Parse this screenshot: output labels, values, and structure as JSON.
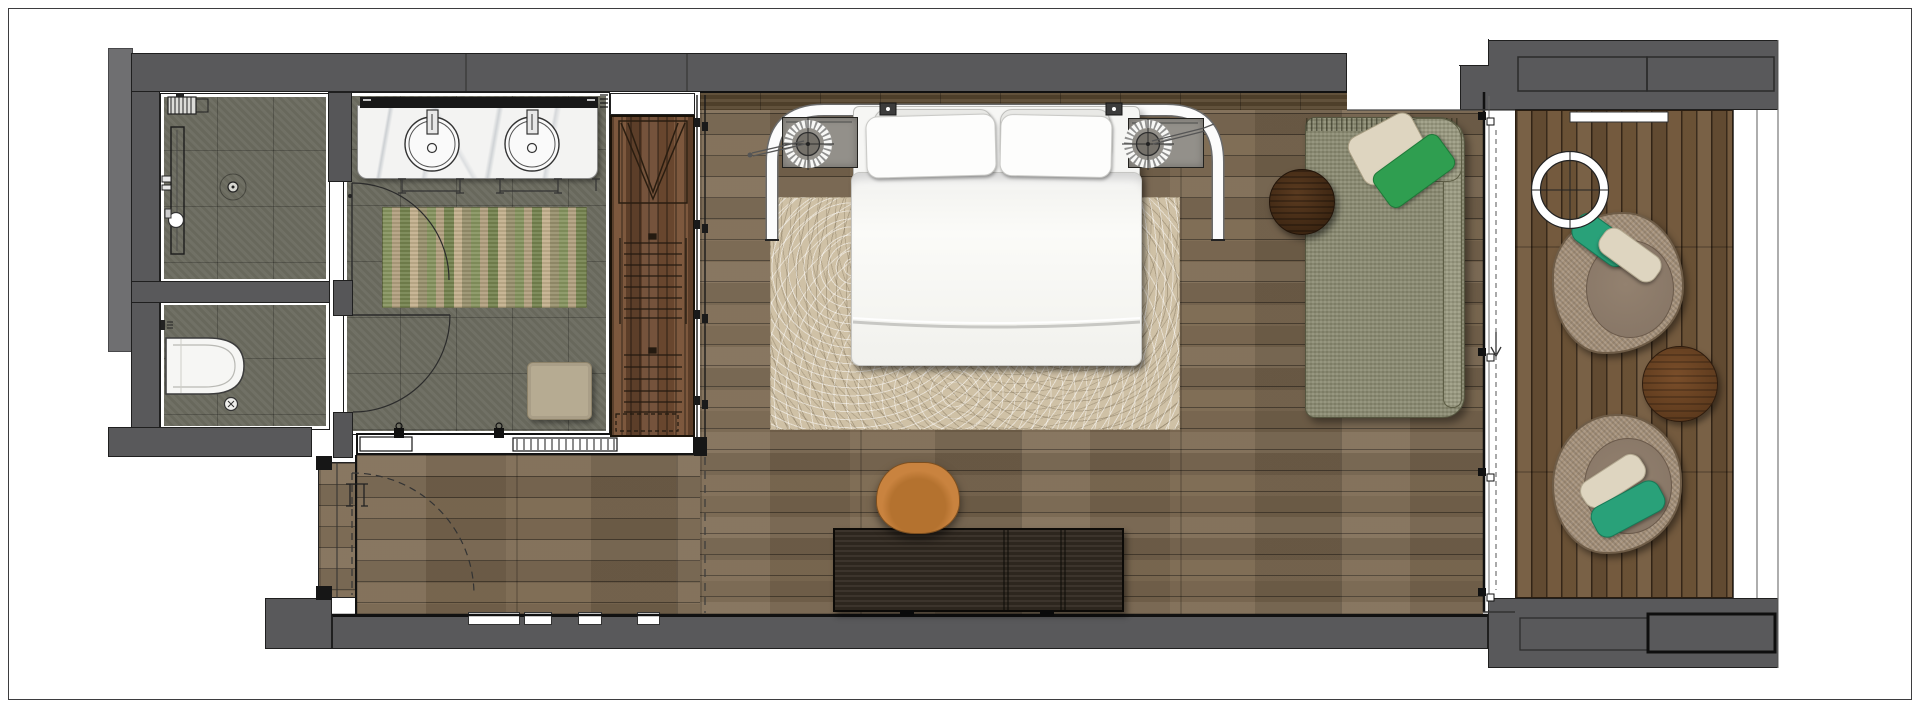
{
  "meta": {
    "width": 1920,
    "height": 708,
    "drawing_type": "hotel-guest-room-floor-plan",
    "text_labels": []
  },
  "palette": {
    "wall": "#59595b",
    "wall-dark": "#565658",
    "outer": "#6f6f71",
    "line": "#1c1c1c",
    "tile": "#6c6c60",
    "marble": "#f3f3f2",
    "wood": "#7b6850",
    "deck": "#6f5538",
    "wardrobe": "#6e4a31",
    "headboard": "#57462f",
    "rug": "#cfc1a6",
    "runner-a": "#87945f",
    "runner-b": "#b2a07f",
    "runner-c": "#75834f",
    "runner-d": "#c3b08d",
    "runner-e": "#98906d",
    "daybed": "#8d8d73",
    "green-pillow": "#2f9e50",
    "teal": "#29a179",
    "cream": "#ded5c0",
    "wicker": "#a5917a",
    "cushion": "#887767",
    "desk": "#342c23",
    "chair": "#c9833f",
    "linen": "#f6f6f4"
  },
  "rooms": [
    {
      "name": "shower-room"
    },
    {
      "name": "water-closet"
    },
    {
      "name": "dressing-area"
    },
    {
      "name": "entry-corridor"
    },
    {
      "name": "bedroom"
    },
    {
      "name": "balcony-deck"
    }
  ],
  "furniture": [
    {
      "name": "rain-shower-head"
    },
    {
      "name": "linear-drain"
    },
    {
      "name": "floor-drain"
    },
    {
      "name": "wall-hung-toilet"
    },
    {
      "name": "double-vanity"
    },
    {
      "name": "vanity-sink",
      "count": 2
    },
    {
      "name": "vanity-mirror"
    },
    {
      "name": "striped-runner-rug"
    },
    {
      "name": "wardrobe-with-hangers"
    },
    {
      "name": "ottoman-stool"
    },
    {
      "name": "king-bed"
    },
    {
      "name": "pillow",
      "count": 4
    },
    {
      "name": "nightstand",
      "count": 2
    },
    {
      "name": "table-lamp",
      "count": 2
    },
    {
      "name": "canopy-rail"
    },
    {
      "name": "area-rug"
    },
    {
      "name": "daybed-chaise"
    },
    {
      "name": "round-side-table",
      "count": 2
    },
    {
      "name": "writing-desk"
    },
    {
      "name": "desk-chair"
    },
    {
      "name": "lounge-egg-chair",
      "count": 2
    },
    {
      "name": "balcony-round-table"
    },
    {
      "name": "deck-light-ring"
    }
  ],
  "doors": [
    {
      "name": "bathroom-door-swing"
    },
    {
      "name": "wc-door-swing"
    },
    {
      "name": "entry-door-swing-dashed"
    },
    {
      "name": "wardrobe-sliding-track"
    },
    {
      "name": "balcony-sliding-door"
    }
  ]
}
